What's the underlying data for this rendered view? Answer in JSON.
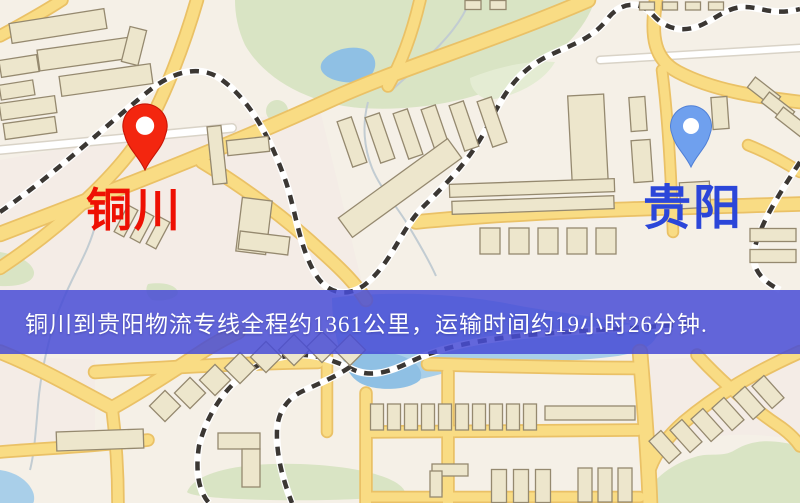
{
  "banner": {
    "text": "铜川到贵阳物流专线全程约1361公里，运输时间约19小时26分钟.",
    "bg_color": "rgba(72,76,214,0.85)",
    "text_color": "#ffffff"
  },
  "route": {
    "origin": "铜川",
    "destination": "贵阳",
    "distance_km": 1361,
    "duration": "19小时26分钟"
  },
  "markers": {
    "origin": {
      "label": "铜川",
      "pin_color": "#F3260F",
      "pin_shade": "#C81405",
      "label_color": "#EE1003"
    },
    "destination": {
      "label": "贵阳",
      "pin_color": "#6FA0EE",
      "pin_shade": "#4F7FD6",
      "label_color": "#2B46D9"
    }
  },
  "map": {
    "bg": "#F5F0E7",
    "colors": {
      "pink_zone": "#F4EAE6",
      "green": "#D9E4C4",
      "green2": "#E4ECD3",
      "water": "#8FC0E4",
      "water_light": "#A9CFE9",
      "river": "#C2CCD2",
      "road_fill": "#F9DC84",
      "road_edge": "#EAC166",
      "white_road_fill": "#FFFFFF",
      "white_road_edge": "#D9D3C7",
      "building_fill": "#EDE6CC",
      "building_edge": "#95896F",
      "rail_dash": "#3B3733",
      "rail_bed": "#FFFFFF"
    },
    "pink_zones": [
      "M0,160 C110,140 230,120 320,110 L366,300 L0,300 Z",
      "M650,360 L800,352 L800,440 C740,430 690,432 650,462 Z",
      "M0,356 L95,360 L95,442 L0,447 Z"
    ],
    "greens": [
      "M235,0 L595,0 C585,30 560,55 525,75 C480,100 420,112 360,108 C310,104 265,80 245,45 C238,30 235,15 235,0 Z",
      "M277,100 a11,11 0 1,0 0.1,0 Z",
      "M0,252 C18,255 32,262 34,272 C35,282 20,287 0,286 Z",
      "M148,284 C162,282 175,284 178,292 C178,298 165,302 152,300 C146,295 145,289 148,284 Z",
      "M187,492 C195,472 240,462 300,464 C360,466 400,478 405,492 C400,503 195,503 187,492 Z",
      "M640,503 C650,482 668,465 695,457 C710,452 722,458 735,450 C755,438 775,440 800,446 L800,503 Z"
    ],
    "greens2": [
      "M470,78 C500,66 530,60 555,62 C545,80 520,95 490,100 C478,98 470,88 470,78 Z"
    ],
    "waters_light": [
      "M332,298 C390,290 460,294 510,304 C565,315 625,318 658,332 C655,346 640,352 618,356 C560,364 500,360 448,372 C430,377 405,384 390,382 C362,378 346,368 342,358 C336,340 332,318 332,298 Z",
      "M0,470 C15,472 28,480 33,492 C35,497 34,503 33,503 L0,503 Z"
    ],
    "waters": [
      "M322,62 C330,50 352,44 366,50 C378,56 378,70 368,78 C354,86 332,82 324,74 C320,70 320,66 322,62 Z",
      "M345,355 C360,350 385,350 402,356 C418,362 424,372 420,380 C410,390 380,392 362,384 C350,378 344,366 345,355 Z"
    ],
    "rivers": [
      "M470,0 C462,22 445,40 430,55 C418,68 402,80 390,92",
      "M96,222 C92,240 84,256 76,272 C66,292 58,310 52,330 C45,355 40,380 38,405 C36,430 34,455 30,470",
      "M368,102 C362,125 364,148 372,168 C380,188 396,205 408,225 C418,242 428,258 436,276"
    ],
    "white_roads": [
      {
        "d": "M0,150 C80,142 160,135 232,128",
        "w": 7
      },
      {
        "d": "M600,60 L800,48",
        "w": 6
      }
    ],
    "roads": [
      {
        "d": "M0,36 C22,24 44,12 62,0",
        "w": 10
      },
      {
        "d": "M197,0 C184,45 165,95 146,128 C122,172 60,228 0,268",
        "w": 11
      },
      {
        "d": "M0,234 C100,196 225,148 330,100 C395,70 490,42 588,0",
        "w": 13
      },
      {
        "d": "M202,162 C245,188 288,220 322,252 C342,270 356,284 366,300",
        "w": 11
      },
      {
        "d": "M420,0 C412,34 402,62 388,86",
        "w": 10
      },
      {
        "d": "M656,0 C650,38 655,60 678,72 C712,90 756,97 800,102",
        "w": 11
      },
      {
        "d": "M662,70 C668,118 671,170 673,232",
        "w": 9
      },
      {
        "d": "M416,222 C540,210 670,208 800,204",
        "w": 12
      },
      {
        "d": "M748,145 C766,152 784,162 800,172",
        "w": 9
      },
      {
        "d": "M95,372 C170,367 250,363 318,362",
        "w": 11
      },
      {
        "d": "M428,364 C495,366 570,368 638,368",
        "w": 11
      },
      {
        "d": "M0,352 C40,368 78,390 112,408 C148,388 180,366 208,348 C218,342 228,336 238,332",
        "w": 12
      },
      {
        "d": "M0,452 C50,448 100,446 148,440",
        "w": 10
      },
      {
        "d": "M327,352 L327,432",
        "w": 9
      },
      {
        "d": "M366,393 L366,503",
        "w": 10
      },
      {
        "d": "M448,372 L448,503",
        "w": 10
      },
      {
        "d": "M640,352 C644,400 648,450 650,503",
        "w": 13
      },
      {
        "d": "M366,432 L638,430",
        "w": 10
      },
      {
        "d": "M366,497 L640,497",
        "w": 9
      },
      {
        "d": "M800,352 C755,372 715,396 684,422 C668,436 656,452 650,468",
        "w": 11
      },
      {
        "d": "M697,355 C722,382 752,408 782,428 C790,434 796,440 800,446",
        "w": 10
      },
      {
        "d": "M112,408 C116,440 118,470 118,503",
        "w": 10
      }
    ],
    "rails": [
      "M0,212 C58,172 112,120 150,90 C178,68 204,66 222,80 C252,102 272,142 286,182 C296,212 300,252 318,278 C331,296 352,297 368,282 C392,261 401,230 421,209 C452,178 472,158 492,118 C506,89 521,70 546,57 C572,44 592,40 609,17 C622,2 640,0 654,16 C667,30 684,32 699,26 C714,20 727,7 744,7 C762,7 772,16 800,9",
      "M800,162 C779,194 761,223 755,247 C750,267 760,280 780,290",
      "M690,324 C610,330 545,332 502,338 C462,343 432,351 410,362 C392,371 372,378 354,370 C337,362 322,356 305,355 C282,354 259,362 242,376 C221,393 206,418 199,446 C195,472 199,492 209,503",
      "M350,367 C334,378 315,385 301,392 C287,399 278,412 277,430 C276,455 283,480 292,503"
    ],
    "buildings": [
      [
        58,
        26,
        96,
        20,
        -9
      ],
      [
        85,
        54,
        94,
        21,
        -8
      ],
      [
        19,
        66,
        38,
        17,
        -9
      ],
      [
        106,
        80,
        92,
        20,
        -8
      ],
      [
        17,
        90,
        34,
        15,
        -9
      ],
      [
        28,
        108,
        56,
        17,
        -8
      ],
      [
        30,
        128,
        52,
        16,
        -8
      ],
      [
        134,
        46,
        17,
        36,
        14
      ],
      [
        217,
        155,
        14,
        58,
        -6
      ],
      [
        248,
        146,
        42,
        15,
        -6
      ],
      [
        254,
        226,
        30,
        54,
        7
      ],
      [
        264,
        243,
        50,
        18,
        7
      ],
      [
        126,
        221,
        11,
        30,
        28
      ],
      [
        142,
        227,
        11,
        30,
        28
      ],
      [
        158,
        233,
        11,
        30,
        28
      ],
      [
        352,
        142,
        15,
        48,
        -19
      ],
      [
        380,
        138,
        15,
        48,
        -19
      ],
      [
        408,
        134,
        15,
        48,
        -19
      ],
      [
        436,
        130,
        15,
        48,
        -19
      ],
      [
        464,
        126,
        15,
        48,
        -19
      ],
      [
        492,
        122,
        15,
        48,
        -19
      ],
      [
        400,
        188,
        135,
        24,
        -36
      ],
      [
        588,
        140,
        36,
        90,
        -3
      ],
      [
        532,
        188,
        165,
        13,
        -2
      ],
      [
        533,
        205,
        162,
        13,
        -2
      ],
      [
        490,
        241,
        20,
        26,
        0
      ],
      [
        519,
        241,
        20,
        26,
        0
      ],
      [
        548,
        241,
        20,
        26,
        0
      ],
      [
        577,
        241,
        20,
        26,
        0
      ],
      [
        606,
        241,
        20,
        26,
        0
      ],
      [
        638,
        114,
        16,
        34,
        -4
      ],
      [
        642,
        161,
        19,
        42,
        -4
      ],
      [
        695,
        195,
        30,
        26,
        -3
      ],
      [
        720,
        113,
        16,
        32,
        -4
      ],
      [
        764,
        92,
        32,
        13,
        38
      ],
      [
        778,
        107,
        32,
        13,
        38
      ],
      [
        792,
        122,
        32,
        13,
        38
      ],
      [
        647,
        6,
        15,
        8,
        0
      ],
      [
        670,
        6,
        15,
        8,
        0
      ],
      [
        693,
        6,
        15,
        8,
        0
      ],
      [
        716,
        6,
        15,
        8,
        0
      ],
      [
        473,
        5,
        16,
        9,
        0
      ],
      [
        498,
        5,
        16,
        9,
        0
      ],
      [
        773,
        235,
        46,
        13,
        0
      ],
      [
        773,
        256,
        46,
        13,
        0
      ],
      [
        100,
        440,
        87,
        19,
        -2
      ],
      [
        165,
        406,
        22,
        22,
        45
      ],
      [
        190,
        393,
        22,
        22,
        45
      ],
      [
        215,
        380,
        22,
        22,
        45
      ],
      [
        240,
        368,
        22,
        22,
        45
      ],
      [
        266,
        357,
        22,
        22,
        45
      ],
      [
        294,
        350,
        22,
        22,
        45
      ],
      [
        322,
        347,
        22,
        22,
        45
      ],
      [
        350,
        350,
        22,
        22,
        45
      ],
      [
        239,
        441,
        42,
        16,
        0
      ],
      [
        251,
        468,
        18,
        38,
        0
      ],
      [
        377,
        417,
        13,
        26,
        0
      ],
      [
        394,
        417,
        13,
        26,
        0
      ],
      [
        411,
        417,
        13,
        26,
        0
      ],
      [
        428,
        417,
        13,
        26,
        0
      ],
      [
        445,
        417,
        13,
        26,
        0
      ],
      [
        462,
        417,
        13,
        26,
        0
      ],
      [
        479,
        417,
        13,
        26,
        0
      ],
      [
        496,
        417,
        13,
        26,
        0
      ],
      [
        513,
        417,
        13,
        26,
        0
      ],
      [
        530,
        417,
        13,
        26,
        0
      ],
      [
        590,
        413,
        90,
        14,
        0
      ],
      [
        499,
        486,
        15,
        33,
        0
      ],
      [
        521,
        486,
        15,
        33,
        0
      ],
      [
        543,
        486,
        15,
        33,
        0
      ],
      [
        585,
        485,
        14,
        34,
        0
      ],
      [
        605,
        485,
        14,
        34,
        0
      ],
      [
        625,
        485,
        14,
        34,
        0
      ],
      [
        450,
        470,
        36,
        12,
        0
      ],
      [
        436,
        484,
        12,
        26,
        0
      ],
      [
        665,
        447,
        16,
        30,
        -42
      ],
      [
        686,
        436,
        16,
        30,
        -42
      ],
      [
        707,
        425,
        16,
        30,
        -42
      ],
      [
        728,
        414,
        16,
        30,
        -42
      ],
      [
        749,
        403,
        16,
        30,
        -42
      ],
      [
        768,
        392,
        16,
        30,
        -42
      ]
    ]
  }
}
